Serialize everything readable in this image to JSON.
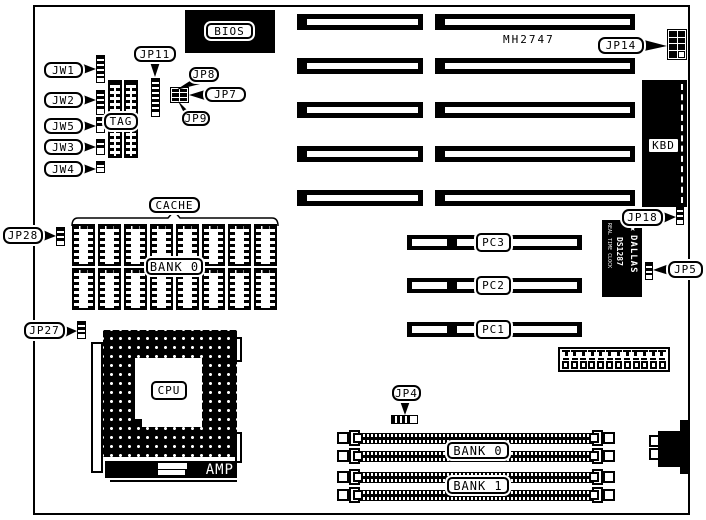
{
  "colors": {
    "ink": "#000000",
    "paper": "#ffffff"
  },
  "board_text": {
    "part_number": "MH2747"
  },
  "callouts": {
    "jw1": "JW1",
    "jw2": "JW2",
    "jw5": "JW5",
    "jw3": "JW3",
    "jw4": "JW4",
    "jp11": "JP11",
    "jp8": "JP8",
    "jp7": "JP7",
    "jp9": "JP9",
    "jp28": "JP28",
    "jp27": "JP27",
    "jp14": "JP14",
    "jp18": "JP18",
    "jp5": "JP5",
    "jp4": "JP4"
  },
  "components": {
    "bios": "BIOS",
    "kbd": "KBD",
    "tag": "TAG",
    "cache": "CACHE",
    "cache_bank": "BANK 0",
    "cpu": "CPU",
    "socket_brand": "AMP",
    "rtc": {
      "brand": "DALLAS",
      "part": "DS1287",
      "subtitle": "REAL TIME CLOCK",
      "star": "★"
    },
    "slots": {
      "pc1": "PC1",
      "pc2": "PC2",
      "pc3": "PC3"
    },
    "memory": {
      "bank0": "BANK 0",
      "bank1": "BANK 1"
    }
  }
}
